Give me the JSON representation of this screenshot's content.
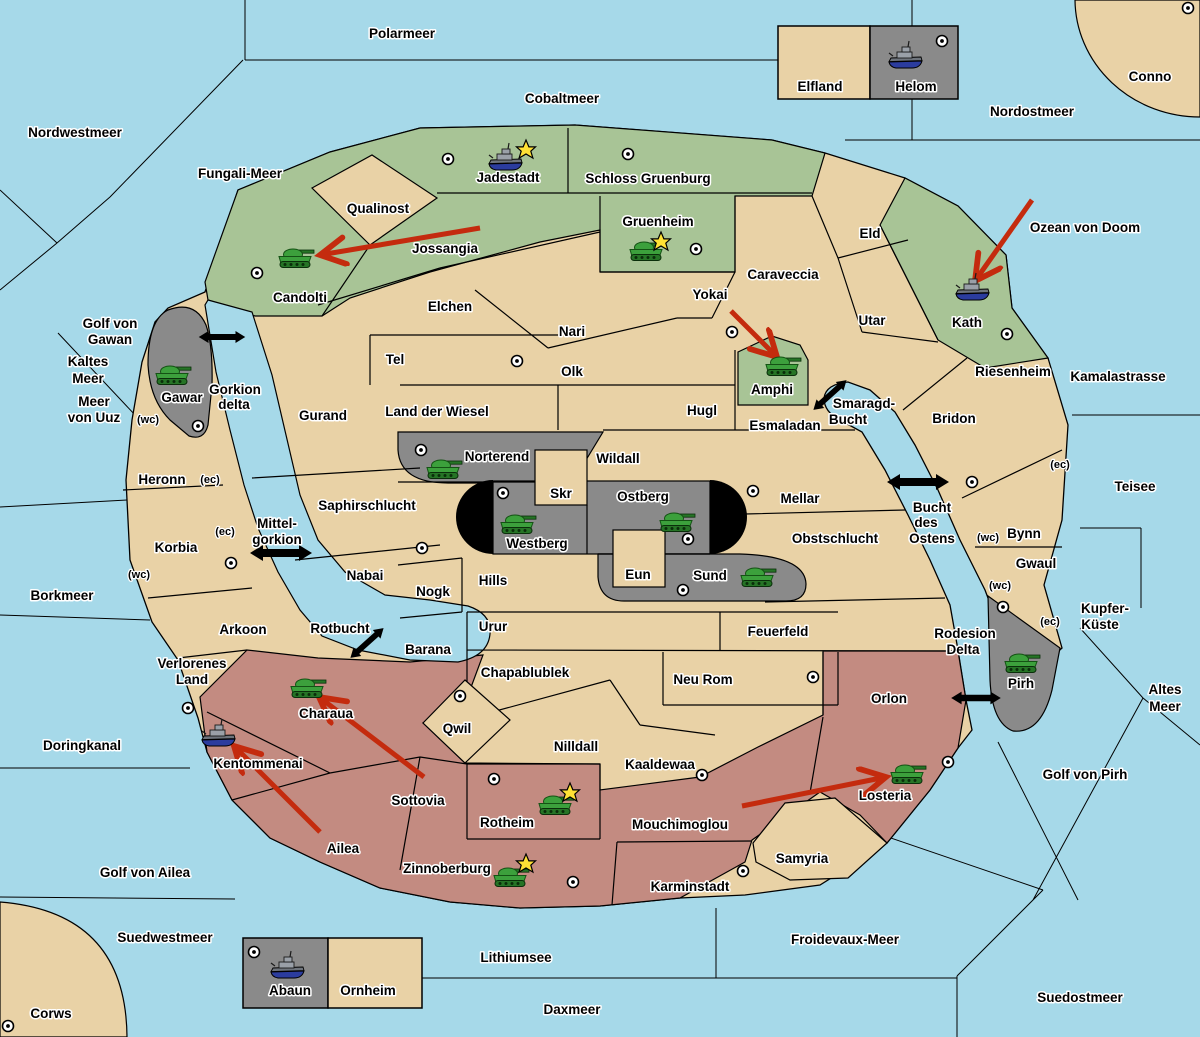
{
  "map": {
    "colors": {
      "sea": "#A6D9E9",
      "land_neutral": "#E9D2A6",
      "faction_green": "#A8C496",
      "faction_gray": "#8A8A8A",
      "faction_rose": "#C38B81",
      "attack_arrow_red": "#C42B0E",
      "ferry_arrow_black": "#000000",
      "tank_green": "#3CA03C",
      "ship_gray": "#9AA0A8",
      "star_yellow": "#FFE135",
      "border_black": "#000000",
      "label_halo_white": "#FFFFFF"
    },
    "sea_labels": [
      {
        "text": "Polarmeer",
        "x": 402,
        "y": 38
      },
      {
        "text": "Cobaltmeer",
        "x": 562,
        "y": 103
      },
      {
        "text": "Nordostmeer",
        "x": 1032,
        "y": 116
      },
      {
        "text": "Conno",
        "x": 1150,
        "y": 81
      },
      {
        "text": "Nordwestmeer",
        "x": 75,
        "y": 137
      },
      {
        "text": "Fungali-Meer",
        "x": 240,
        "y": 178
      },
      {
        "text": "Ozean von Doom",
        "x": 1085,
        "y": 232
      },
      {
        "text": "Kaltes",
        "x": 88,
        "y": 366
      },
      {
        "text": "Meer",
        "x": 88,
        "y": 383
      },
      {
        "text": "Golf von",
        "x": 110,
        "y": 328
      },
      {
        "text": "Gawan",
        "x": 110,
        "y": 344
      },
      {
        "text": "Meer",
        "x": 94,
        "y": 406
      },
      {
        "text": "von Uuz",
        "x": 94,
        "y": 422
      },
      {
        "text": "Borkmeer",
        "x": 62,
        "y": 600
      },
      {
        "text": "Doringkanal",
        "x": 82,
        "y": 750
      },
      {
        "text": "Golf von Ailea",
        "x": 145,
        "y": 877
      },
      {
        "text": "Suedwestmeer",
        "x": 165,
        "y": 942
      },
      {
        "text": "Corws",
        "x": 51,
        "y": 1018
      },
      {
        "text": "Lithiumsee",
        "x": 516,
        "y": 962
      },
      {
        "text": "Daxmeer",
        "x": 572,
        "y": 1014
      },
      {
        "text": "Froidevaux-Meer",
        "x": 845,
        "y": 944
      },
      {
        "text": "Suedostmeer",
        "x": 1080,
        "y": 1002
      },
      {
        "text": "Golf von Pirh",
        "x": 1085,
        "y": 779
      },
      {
        "text": "Altes",
        "x": 1165,
        "y": 694
      },
      {
        "text": "Meer",
        "x": 1165,
        "y": 711
      },
      {
        "text": "Kupfer-",
        "x": 1105,
        "y": 613
      },
      {
        "text": "Küste",
        "x": 1100,
        "y": 629
      },
      {
        "text": "Teisee",
        "x": 1135,
        "y": 491
      },
      {
        "text": "Kamalastrasse",
        "x": 1118,
        "y": 381
      },
      {
        "text": "Smaragd-",
        "x": 864,
        "y": 408
      },
      {
        "text": "Bucht",
        "x": 848,
        "y": 424
      },
      {
        "text": "Bucht",
        "x": 932,
        "y": 512
      },
      {
        "text": "des",
        "x": 926,
        "y": 527
      },
      {
        "text": "Ostens",
        "x": 932,
        "y": 543
      },
      {
        "text": "Mittel-",
        "x": 277,
        "y": 528
      },
      {
        "text": "gorkion",
        "x": 277,
        "y": 544
      },
      {
        "text": "Gorkion",
        "x": 235,
        "y": 394
      },
      {
        "text": "delta",
        "x": 234,
        "y": 409
      },
      {
        "text": "Rotbucht",
        "x": 340,
        "y": 633
      },
      {
        "text": "Rodesion",
        "x": 965,
        "y": 638
      },
      {
        "text": "Delta",
        "x": 963,
        "y": 654
      }
    ],
    "territory_labels": [
      {
        "text": "Qualinost",
        "x": 378,
        "y": 213
      },
      {
        "text": "Jossangia",
        "x": 445,
        "y": 253
      },
      {
        "text": "Candolti",
        "x": 300,
        "y": 302
      },
      {
        "text": "Jadestadt",
        "x": 508,
        "y": 182
      },
      {
        "text": "Schloss Gruenburg",
        "x": 648,
        "y": 183
      },
      {
        "text": "Gruenheim",
        "x": 658,
        "y": 226
      },
      {
        "text": "Caraveccia",
        "x": 783,
        "y": 279
      },
      {
        "text": "Yokai",
        "x": 710,
        "y": 299
      },
      {
        "text": "Eld",
        "x": 870,
        "y": 238
      },
      {
        "text": "Utar",
        "x": 872,
        "y": 325
      },
      {
        "text": "Kath",
        "x": 967,
        "y": 327
      },
      {
        "text": "Riesenheim",
        "x": 1013,
        "y": 376
      },
      {
        "text": "Bridon",
        "x": 954,
        "y": 423
      },
      {
        "text": "Amphi",
        "x": 772,
        "y": 394
      },
      {
        "text": "Esmaladan",
        "x": 785,
        "y": 430
      },
      {
        "text": "Elchen",
        "x": 450,
        "y": 311
      },
      {
        "text": "Nari",
        "x": 572,
        "y": 336
      },
      {
        "text": "Tel",
        "x": 395,
        "y": 364
      },
      {
        "text": "Olk",
        "x": 572,
        "y": 376
      },
      {
        "text": "Land der Wiesel",
        "x": 437,
        "y": 416
      },
      {
        "text": "Gurand",
        "x": 323,
        "y": 420
      },
      {
        "text": "Hugl",
        "x": 702,
        "y": 415
      },
      {
        "text": "Norterend",
        "x": 497,
        "y": 461
      },
      {
        "text": "Wildall",
        "x": 618,
        "y": 463
      },
      {
        "text": "Skr",
        "x": 561,
        "y": 498
      },
      {
        "text": "Ostberg",
        "x": 643,
        "y": 501
      },
      {
        "text": "Westberg",
        "x": 537,
        "y": 548
      },
      {
        "text": "Eun",
        "x": 638,
        "y": 579
      },
      {
        "text": "Sund",
        "x": 710,
        "y": 580
      },
      {
        "text": "Mellar",
        "x": 800,
        "y": 503
      },
      {
        "text": "Obstschlucht",
        "x": 835,
        "y": 543
      },
      {
        "text": "Hills",
        "x": 493,
        "y": 585
      },
      {
        "text": "Nogk",
        "x": 433,
        "y": 596
      },
      {
        "text": "Nabai",
        "x": 365,
        "y": 580
      },
      {
        "text": "Saphirschlucht",
        "x": 367,
        "y": 510
      },
      {
        "text": "Heronn",
        "x": 162,
        "y": 484
      },
      {
        "text": "Korbia",
        "x": 176,
        "y": 552
      },
      {
        "text": "Arkoon",
        "x": 243,
        "y": 634
      },
      {
        "text": "Verlorenes",
        "x": 192,
        "y": 668
      },
      {
        "text": "Land",
        "x": 192,
        "y": 684
      },
      {
        "text": "Kentommenai",
        "x": 258,
        "y": 768
      },
      {
        "text": "Charaua",
        "x": 326,
        "y": 718
      },
      {
        "text": "Ailea",
        "x": 343,
        "y": 853
      },
      {
        "text": "Sottovia",
        "x": 418,
        "y": 805
      },
      {
        "text": "Barana",
        "x": 428,
        "y": 654
      },
      {
        "text": "Urur",
        "x": 493,
        "y": 631
      },
      {
        "text": "Feuerfeld",
        "x": 778,
        "y": 636
      },
      {
        "text": "Chapablublek",
        "x": 525,
        "y": 677
      },
      {
        "text": "Neu Rom",
        "x": 703,
        "y": 684
      },
      {
        "text": "Qwil",
        "x": 457,
        "y": 733
      },
      {
        "text": "Nilldall",
        "x": 576,
        "y": 751
      },
      {
        "text": "Kaaldewaa",
        "x": 660,
        "y": 769
      },
      {
        "text": "Mouchimoglou",
        "x": 680,
        "y": 829
      },
      {
        "text": "Rotheim",
        "x": 507,
        "y": 827
      },
      {
        "text": "Zinnoberburg",
        "x": 447,
        "y": 873
      },
      {
        "text": "Karminstadt",
        "x": 690,
        "y": 891
      },
      {
        "text": "Samyria",
        "x": 802,
        "y": 863
      },
      {
        "text": "Losteria",
        "x": 885,
        "y": 800
      },
      {
        "text": "Orlon",
        "x": 889,
        "y": 703
      },
      {
        "text": "Pirh",
        "x": 1021,
        "y": 688
      },
      {
        "text": "Gwaul",
        "x": 1036,
        "y": 568
      },
      {
        "text": "Bynn",
        "x": 1024,
        "y": 538
      },
      {
        "text": "Gawar",
        "x": 182,
        "y": 402
      },
      {
        "text": "Elfland",
        "x": 820,
        "y": 91
      },
      {
        "text": "Helom",
        "x": 916,
        "y": 91
      },
      {
        "text": "Abaun",
        "x": 290,
        "y": 995
      },
      {
        "text": "Ornheim",
        "x": 368,
        "y": 995
      }
    ],
    "small_labels": [
      {
        "text": "(wc)",
        "x": 148,
        "y": 423
      },
      {
        "text": "(wc)",
        "x": 139,
        "y": 578
      },
      {
        "text": "(wc)",
        "x": 988,
        "y": 541
      },
      {
        "text": "(wc)",
        "x": 1000,
        "y": 589
      },
      {
        "text": "(ec)",
        "x": 210,
        "y": 483
      },
      {
        "text": "(ec)",
        "x": 225,
        "y": 535
      },
      {
        "text": "(ec)",
        "x": 1060,
        "y": 468
      },
      {
        "text": "(ec)",
        "x": 1050,
        "y": 625
      }
    ],
    "tanks": [
      {
        "territory": "Candolti",
        "x": 296,
        "y": 258
      },
      {
        "territory": "Gawar",
        "x": 173,
        "y": 375
      },
      {
        "territory": "Gruenheim",
        "x": 647,
        "y": 251
      },
      {
        "territory": "Amphi",
        "x": 783,
        "y": 366
      },
      {
        "territory": "Norterend",
        "x": 444,
        "y": 469
      },
      {
        "territory": "Westberg",
        "x": 518,
        "y": 524
      },
      {
        "territory": "Ostberg",
        "x": 677,
        "y": 522
      },
      {
        "territory": "Sund",
        "x": 758,
        "y": 577
      },
      {
        "territory": "Charaua",
        "x": 308,
        "y": 688
      },
      {
        "territory": "Rotheim",
        "x": 556,
        "y": 805
      },
      {
        "territory": "Zinnoberburg",
        "x": 511,
        "y": 877
      },
      {
        "territory": "Losteria",
        "x": 908,
        "y": 774
      },
      {
        "territory": "Pirh",
        "x": 1022,
        "y": 663
      }
    ],
    "ships": [
      {
        "territory": "Jadestadt",
        "x": 505,
        "y": 160
      },
      {
        "territory": "Helom",
        "x": 905,
        "y": 58
      },
      {
        "territory": "Kath",
        "x": 972,
        "y": 290
      },
      {
        "territory": "Kentommenai",
        "x": 218,
        "y": 736
      },
      {
        "territory": "Abaun",
        "x": 287,
        "y": 968
      }
    ],
    "stars": [
      {
        "x": 526,
        "y": 150
      },
      {
        "x": 661,
        "y": 242
      },
      {
        "x": 570,
        "y": 793
      },
      {
        "x": 526,
        "y": 864
      }
    ],
    "towns": [
      {
        "x": 448,
        "y": 159
      },
      {
        "x": 628,
        "y": 154
      },
      {
        "x": 696,
        "y": 249
      },
      {
        "x": 257,
        "y": 273
      },
      {
        "x": 732,
        "y": 332
      },
      {
        "x": 1007,
        "y": 334
      },
      {
        "x": 517,
        "y": 361
      },
      {
        "x": 198,
        "y": 426
      },
      {
        "x": 421,
        "y": 450
      },
      {
        "x": 503,
        "y": 493
      },
      {
        "x": 688,
        "y": 539
      },
      {
        "x": 753,
        "y": 491
      },
      {
        "x": 972,
        "y": 482
      },
      {
        "x": 231,
        "y": 563
      },
      {
        "x": 422,
        "y": 548
      },
      {
        "x": 683,
        "y": 590
      },
      {
        "x": 460,
        "y": 696
      },
      {
        "x": 188,
        "y": 708
      },
      {
        "x": 494,
        "y": 779
      },
      {
        "x": 573,
        "y": 882
      },
      {
        "x": 743,
        "y": 871
      },
      {
        "x": 948,
        "y": 762
      },
      {
        "x": 813,
        "y": 677
      },
      {
        "x": 702,
        "y": 775
      },
      {
        "x": 1003,
        "y": 607
      },
      {
        "x": 942,
        "y": 41
      },
      {
        "x": 1188,
        "y": 8
      },
      {
        "x": 8,
        "y": 1026
      },
      {
        "x": 254,
        "y": 952
      }
    ],
    "attack_arrows": [
      {
        "x1": 480,
        "y1": 228,
        "x2": 320,
        "y2": 255
      },
      {
        "x1": 731,
        "y1": 311,
        "x2": 777,
        "y2": 357
      },
      {
        "x1": 1032,
        "y1": 200,
        "x2": 975,
        "y2": 281
      },
      {
        "x1": 424,
        "y1": 777,
        "x2": 319,
        "y2": 697
      },
      {
        "x1": 320,
        "y1": 832,
        "x2": 234,
        "y2": 746
      },
      {
        "x1": 742,
        "y1": 806,
        "x2": 886,
        "y2": 777
      }
    ],
    "ferry_arrows": [
      {
        "x": 222,
        "y": 337,
        "angle": 0,
        "scale": 0.75
      },
      {
        "x": 281,
        "y": 553,
        "angle": 0,
        "scale": 1.0
      },
      {
        "x": 918,
        "y": 482,
        "angle": 0,
        "scale": 1.0
      },
      {
        "x": 830,
        "y": 395,
        "angle": -42,
        "scale": 0.72
      },
      {
        "x": 367,
        "y": 643,
        "angle": -42,
        "scale": 0.72
      },
      {
        "x": 976,
        "y": 698,
        "angle": 0,
        "scale": 0.8
      }
    ]
  }
}
